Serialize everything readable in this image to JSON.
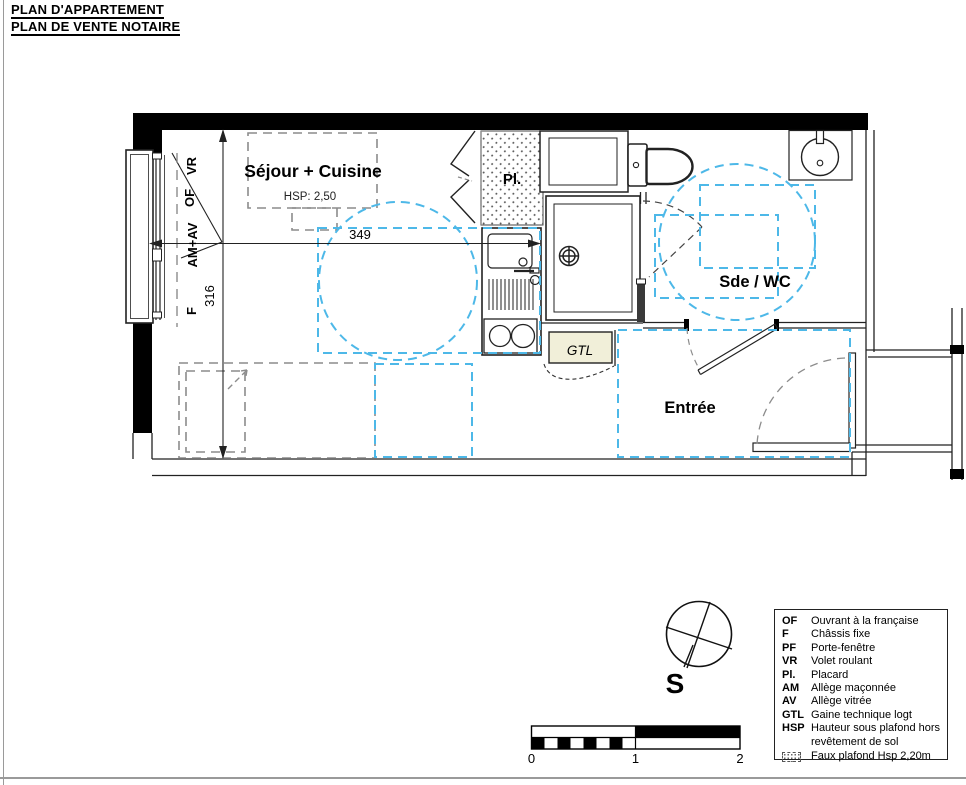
{
  "colors": {
    "accessibility_blue": "#4db8e8",
    "dash_gray": "#8c8c8c",
    "gtl_fill": "#f1efd9",
    "wall_black": "#000000"
  },
  "header": {
    "title_line1": "PLAN D'APPARTEMENT",
    "title_line2": "PLAN DE VENTE NOTAIRE"
  },
  "plan": {
    "room_labels": {
      "sejour_cuisine": "Séjour + Cuisine",
      "sejour_hsp": "HSP: 2,50",
      "placard": "Pl.",
      "sde_wc": "Sde / WC",
      "entree": "Entrée",
      "gtl": "GTL"
    },
    "window_labels": {
      "vr": "VR",
      "of": "OF",
      "am_av": "AM+AV",
      "f": "F"
    },
    "dimensions": {
      "width_cm": "349",
      "depth_cm": "316"
    }
  },
  "compass": {
    "south_label": "S"
  },
  "scale_bar": {
    "tick0": "0",
    "tick1": "1",
    "tick2": "2"
  },
  "legend": {
    "items": [
      {
        "abbr": "OF",
        "label": "Ouvrant à la française"
      },
      {
        "abbr": "F",
        "label": "Châssis fixe"
      },
      {
        "abbr": "PF",
        "label": "Porte-fenêtre"
      },
      {
        "abbr": "VR",
        "label": "Volet roulant"
      },
      {
        "abbr": "Pl.",
        "label": "Placard"
      },
      {
        "abbr": "AM",
        "label": "Allège maçonnée"
      },
      {
        "abbr": "AV",
        "label": "Allège vitrée"
      },
      {
        "abbr": "GTL",
        "label": "Gaine technique logt"
      },
      {
        "abbr": "HSP",
        "label": "Hauteur sous plafond hors revêtement de sol"
      }
    ],
    "faux_plafond_label": "Faux plafond Hsp 2,20m"
  }
}
